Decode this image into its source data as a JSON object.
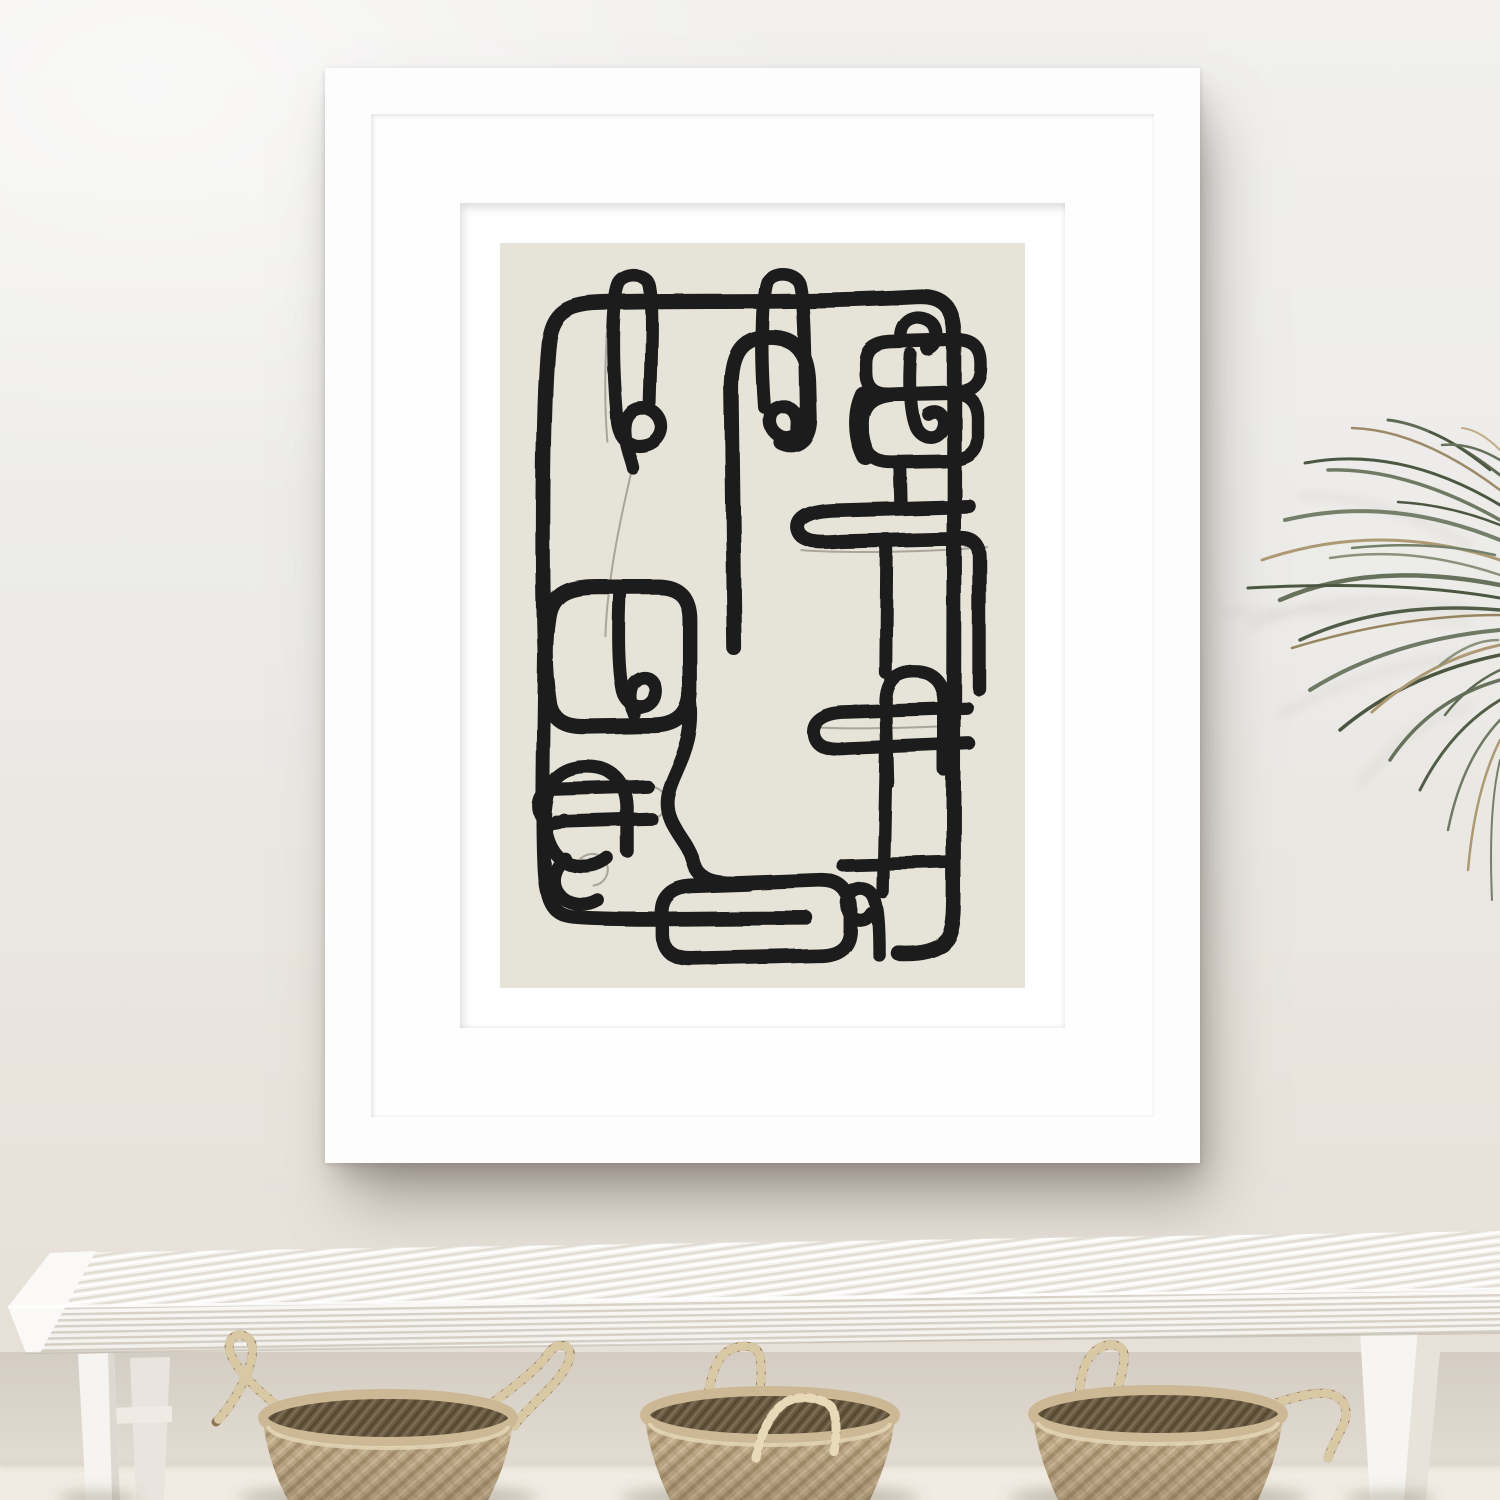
{
  "meta": {
    "domain": "Natural-Image",
    "canvas": {
      "width": 1500,
      "height": 1500
    }
  },
  "scene": {
    "description": "Interior photo: framed abstract line-art print on a light wall above a white woven-top bench with three seagrass baskets; palm fronds enter from the right",
    "wall_top_color": "#F1F0EE",
    "wall_bottom_color": "#E4DED5",
    "floor_color": "#F1ECE3"
  },
  "frame": {
    "style": "white gallery frame with wide white mat",
    "frame_color": "#FDFDFD",
    "mat_color": "#FFFFFF",
    "left": 325,
    "top": 68,
    "width": 875,
    "height": 1095,
    "molding_width": 46,
    "mat_opening_inset": 135,
    "print_border": 40,
    "shadow_color": "rgba(96,88,80,0.5)"
  },
  "artwork": {
    "alt": "Black continuous-line abstract drawing of interlocking loops and rounded rectangles on a warm beige background",
    "style": "hand-drawn single-line abstract, thick brush strokes with faint pencil ghost lines",
    "background_color": "#E6E3D8",
    "line_color": "#1D1C1A",
    "ghost_line_color": "#6B675E"
  },
  "bench": {
    "description": "White bench with woven cord seat seen in slight perspective, legs at both ends",
    "frame_color": "#F6F5F1",
    "cord_shadow_color": "#D9D3C9",
    "leg_shadow_color": "#E9E5DE"
  },
  "baskets": {
    "count": 3,
    "weave": "diagonal diamond seagrass",
    "body_color": "#C7B28F",
    "interior_color": "#6A5B47",
    "rim_color": "#CDB896",
    "handle_dark_color": "#8E7555",
    "handle_light_color": "#D8C7A5",
    "items": [
      {
        "position": "left",
        "handles": "two upright outward-leaning twisted loops"
      },
      {
        "position": "middle",
        "handles": "one tall upright loop, one loop folded down across the rim"
      },
      {
        "position": "right",
        "handles": "one upright loop, one loop curled outward to the right"
      }
    ]
  },
  "plant": {
    "description": "Arching palm / dracaena fronds entering from right edge, green blades mixed with dry tan blades",
    "green_color": "#6F7A65",
    "dark_green_color": "#4C5742",
    "tan_color": "#AD9973"
  }
}
